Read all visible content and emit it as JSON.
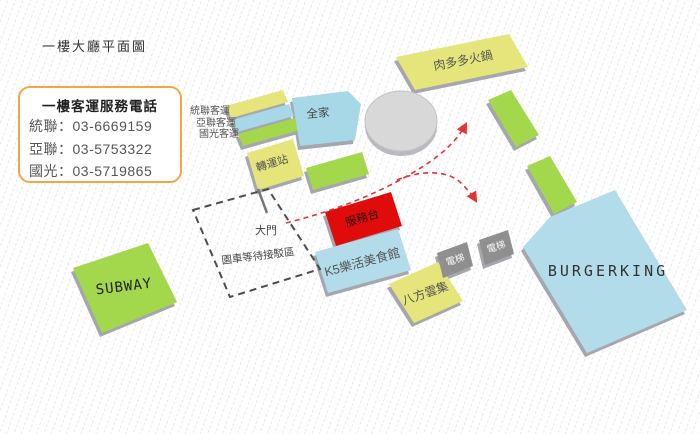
{
  "page": {
    "title": "一樓大廳平面圖"
  },
  "phone_box": {
    "title": "一樓客運服務電話",
    "lines": [
      "統聯：03-6669159",
      "亞聯：03-5753322",
      "國光：03-5719865"
    ]
  },
  "bus_platform_labels": [
    "統聯客運",
    "亞聯客運",
    "國光客運"
  ],
  "locations": {
    "transfer_station": "轉運站",
    "family_mart": "全家",
    "meat_hotpot": "肉多多火鍋",
    "service_desk": "服務台",
    "k5_food_hall": "K5樂活美食館",
    "bafang_dumpling": "八方雲集",
    "elevator": "電梯",
    "burger_king": "BURGERKING",
    "subway": "SUBWAY",
    "main_gate": "大門",
    "shuttle_waiting_area": "園車等待接駁區"
  },
  "colors": {
    "yellow_block": "#e5e57c",
    "blue_block": "#a7d8e8",
    "green_block": "#a3d84c",
    "service_desk_red": "#e00b0b",
    "elevator_gray": "#8f8f8f",
    "phone_box_border": "#f5a542",
    "route_arrow": "#e43333"
  }
}
